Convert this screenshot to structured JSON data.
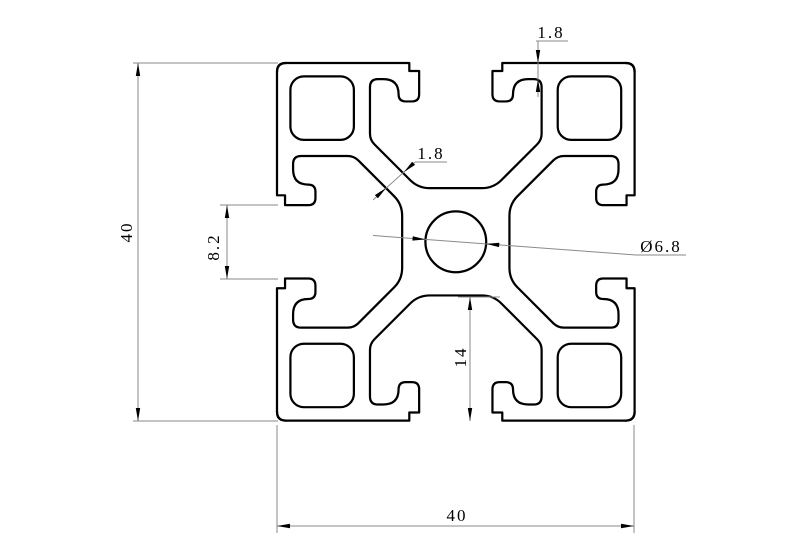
{
  "drawing": {
    "type": "technical-section-drawing",
    "subject": "aluminum extrusion profile cross-section",
    "colors": {
      "outline": "#000000",
      "dim_line": "#8a8a8a",
      "text": "#000000",
      "background": "#ffffff"
    },
    "dimensions": {
      "overall_height": "40",
      "overall_width": "40",
      "slot_opening": "8.2",
      "lip_thickness": "1.8",
      "web_thickness": "1.8",
      "center_hole_diameter": "Ø6.8",
      "slot_depth": "14"
    }
  }
}
